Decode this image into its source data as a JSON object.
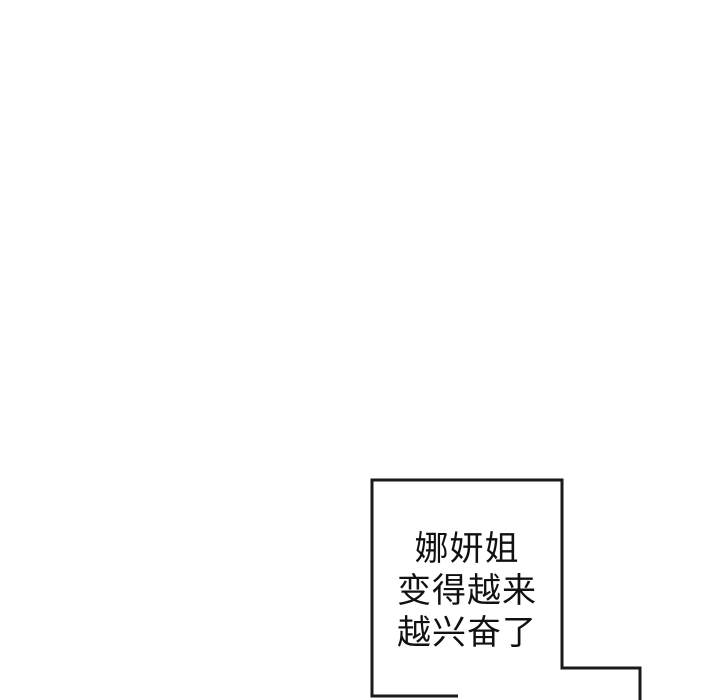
{
  "page": {
    "background_color": "#ffffff"
  },
  "panel": {
    "border_color": "#1a1a1a",
    "border_width": "3"
  },
  "speech_bubble": {
    "text_color": "#111111",
    "lines": [
      "娜妍姐",
      "变得越来",
      "越兴奋了"
    ],
    "full_text": "娜妍姐变得越来越兴奋了"
  }
}
